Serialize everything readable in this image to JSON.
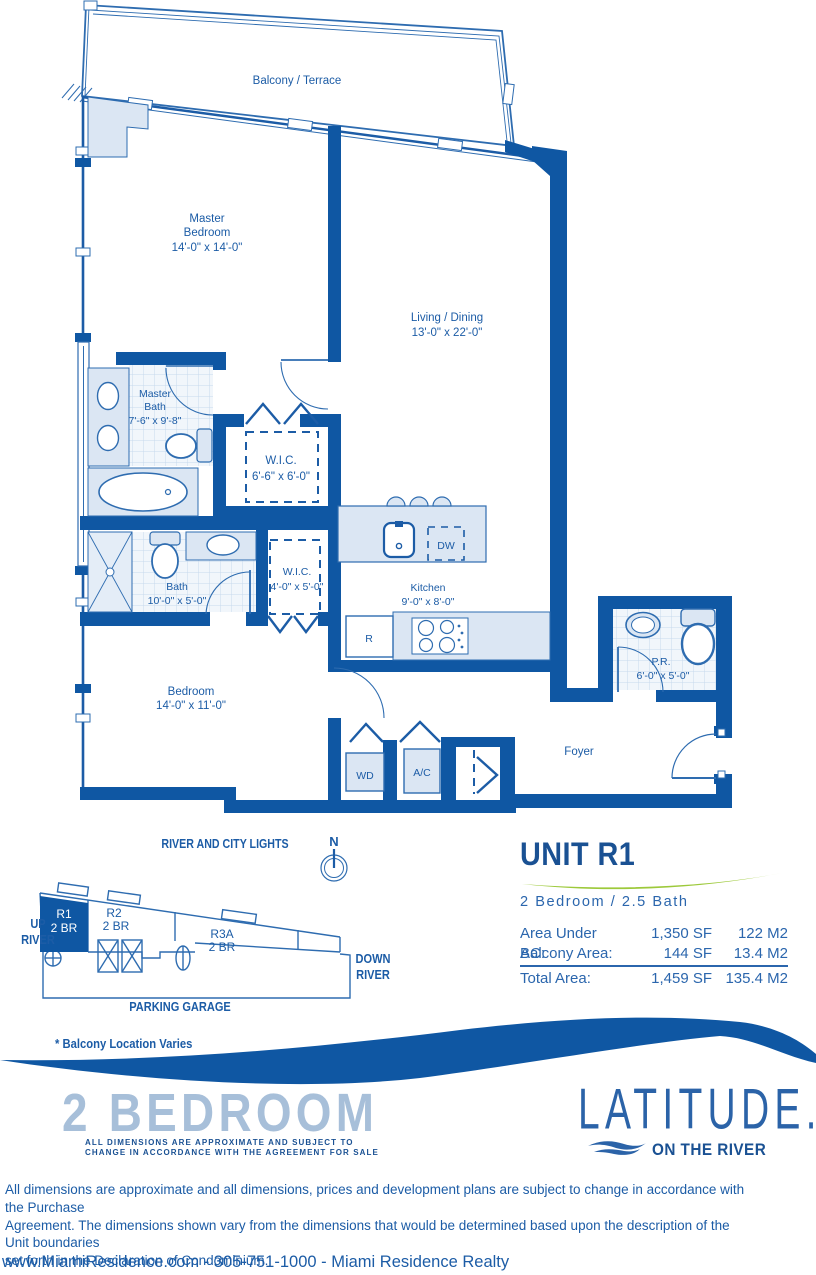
{
  "colors": {
    "wall_blue": "#0F57A3",
    "line_blue": "#2e6cb0",
    "text_blue": "#1c5ca6",
    "navy": "#1A5193",
    "light_fill": "#dbe6f3",
    "heading_light_blue": "#a7bfd9",
    "accent_green": "#9DC93B"
  },
  "rooms": {
    "balcony": {
      "label": "Balcony / Terrace"
    },
    "master_bedroom": {
      "line1": "Master",
      "line2": "Bedroom",
      "dims": "14'-0\" x 14'-0\""
    },
    "living_dining": {
      "name": "Living / Dining",
      "dims": "13'-0\" x 22'-0\""
    },
    "master_bath": {
      "line1": "Master",
      "line2": "Bath",
      "dims": "7'-6\" x 9'-8\""
    },
    "wic_master": {
      "name": "W.I.C.",
      "dims": "6'-6\" x 6'-0\""
    },
    "bath": {
      "name": "Bath",
      "dims": "10'-0\" x 5'-0\""
    },
    "wic_hall": {
      "name": "W.I.C.",
      "dims": "4'-0\" x 5'-0\""
    },
    "kitchen": {
      "name": "Kitchen",
      "dims": "9'-0\" x 8'-0\""
    },
    "bedroom": {
      "name": "Bedroom",
      "dims": "14'-0\" x 11'-0\""
    },
    "powder_room": {
      "name": "P.R.",
      "dims": "6'-0\" x 5'-0\""
    },
    "foyer": {
      "name": "Foyer"
    }
  },
  "appliances": {
    "wd": "WD",
    "ac": "A/C",
    "dw": "DW",
    "fridge": "R"
  },
  "site_plan": {
    "river_label": "RIVER AND CITY LIGHTS",
    "compass_n": "N",
    "up_line1": "UP",
    "up_line2": "RIVER",
    "down_line1": "DOWN",
    "down_line2": "RIVER",
    "parking": "PARKING GARAGE",
    "note": "* Balcony Location Varies",
    "units": {
      "r1": {
        "id": "R1",
        "type": "2 BR"
      },
      "r2": {
        "id": "R2",
        "type": "2 BR"
      },
      "r3a": {
        "id": "R3A",
        "type": "2 BR"
      }
    }
  },
  "unit_info": {
    "title": "UNIT R1",
    "subtitle": "2 Bedroom / 2.5 Bath",
    "rows": [
      {
        "label": "Area Under AC:",
        "sf": "1,350 SF",
        "m2": "122 M2"
      },
      {
        "label": "Balcony Area:",
        "sf": "144 SF",
        "m2": "13.4 M2"
      },
      {
        "label": "Total Area:",
        "sf": "1,459 SF",
        "m2": "135.4 M2"
      }
    ]
  },
  "marketing": {
    "plan_name": "2 BEDROOM",
    "fine_print1": "ALL DIMENSIONS ARE APPROXIMATE AND SUBJECT TO",
    "fine_print2": "CHANGE IN ACCORDANCE WITH THE AGREEMENT FOR SALE",
    "logo_text": "LATITUDE.",
    "logo_tagline": "ON THE RIVER"
  },
  "legal": {
    "line1": "All dimensions are approximate and all dimensions, prices and development plans are subject to change in accordance with the Purchase",
    "line2": "Agreement. The dimensions shown vary from the dimensions that would be determined based upon the description of the Unit boundaries",
    "line3": "set forth in the Declaration of Condominium."
  },
  "footer": {
    "contact": "www.MiamiResidence.com  -  305-751-1000  -  Miami Residence Realty"
  }
}
